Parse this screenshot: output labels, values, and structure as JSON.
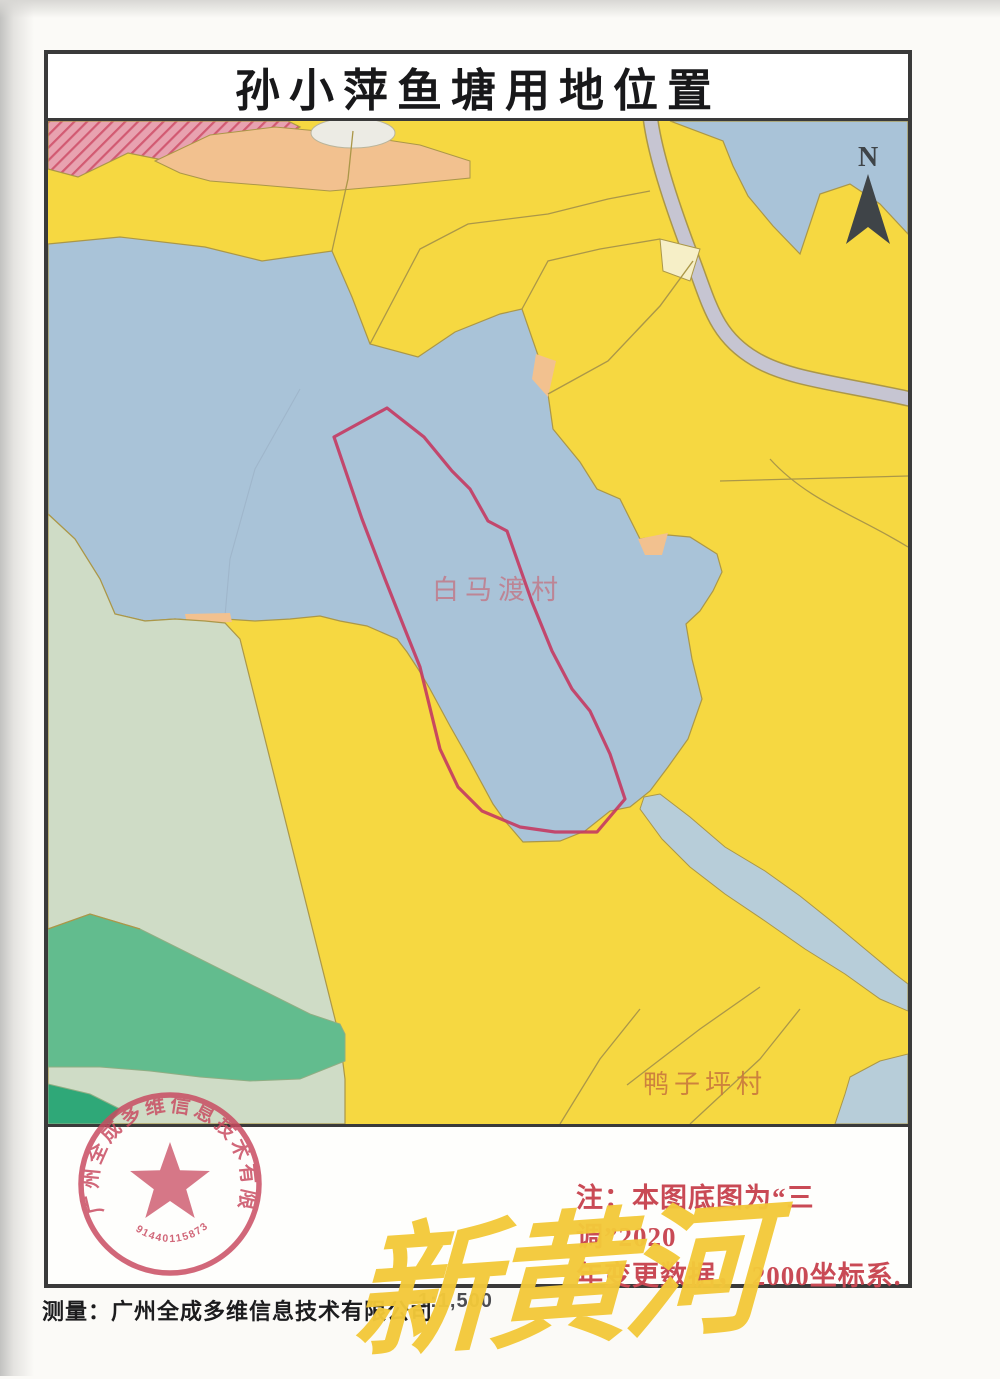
{
  "page": {
    "title": "孙小萍鱼塘用地位置",
    "compass": "N",
    "scale": "1:1,500",
    "surveyor": "测量：广州全成多维信息技术有限公司",
    "note": {
      "line1": "注：本图底图为“三调”2020",
      "line2": "年变更数据， 2000坐标系."
    },
    "watermark": "新黄河"
  },
  "map": {
    "village_labels": [
      {
        "text": "白马渡村"
      },
      {
        "text": "鸭子坪村"
      }
    ],
    "parcel_outline": "孙小萍鱼塘红线范围"
  },
  "stamp": {
    "company": "广州全成多维信息技术有限公司",
    "code": "914401158734874746"
  },
  "colors": {
    "farmland_yellow": "#f6d841",
    "water_blue": "#a9c3d8",
    "stream_blue": "#b7cdd9",
    "pale_green": "#cfdcc6",
    "mid_green": "#62bc8e",
    "dark_green": "#2fa878",
    "pink": "#e8a2b0",
    "hatch_red": "#d25a72",
    "peach": "#f2c18f",
    "cream": "#f6efc7",
    "road_gray": "#c6c5d2",
    "boundary_olive": "#ab9748",
    "parcel_red": "#c43a62",
    "label_pink": "#c4717f",
    "label_orange": "#c9793d",
    "note_red": "#c94a55",
    "stamp_red": "#c94b61",
    "watermark_yellow": "#f3c93a",
    "frame_dark": "#3a3a3a",
    "compass_dark": "#3f4448"
  }
}
